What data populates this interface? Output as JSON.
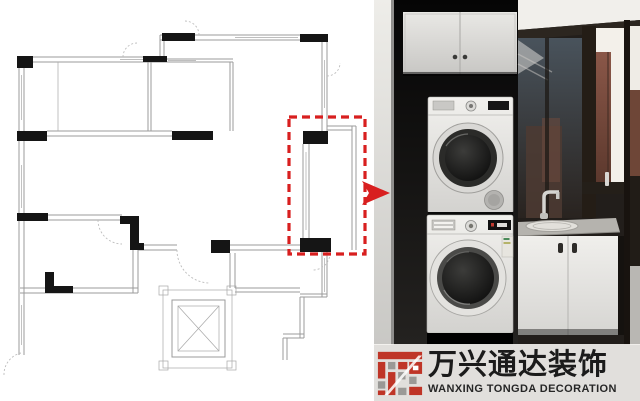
{
  "watermark": {
    "brand_cn": "万兴通达装饰",
    "brand_en": "WANXING TONGDA DECORATION"
  },
  "colors": {
    "highlight_red": "#d81f1f",
    "logo_red": "#bf3527",
    "logo_gray": "#9a9996",
    "plan_wall_gray": "#9b9b9b",
    "plan_column_black": "#151515"
  },
  "floorplan": {
    "type": "apartment-floor-plan",
    "features": [
      "exterior-walls",
      "interior-walls",
      "window-symbols",
      "door-swing-arcs",
      "structural-columns",
      "elevator-shaft",
      "corridor"
    ],
    "highlight": {
      "shape": "dashed-rectangle",
      "color": "#d81f1f",
      "marks": "laundry-balcony"
    }
  },
  "callout": {
    "direction": "right",
    "color": "#d81f1f"
  },
  "photo_scene": {
    "elements": [
      "overhead-cabinet",
      "stacked-dryer",
      "stacked-washer",
      "laundry-sink-cabinet",
      "faucet",
      "stone-countertop",
      "balcony-windows",
      "dark-floor"
    ]
  }
}
